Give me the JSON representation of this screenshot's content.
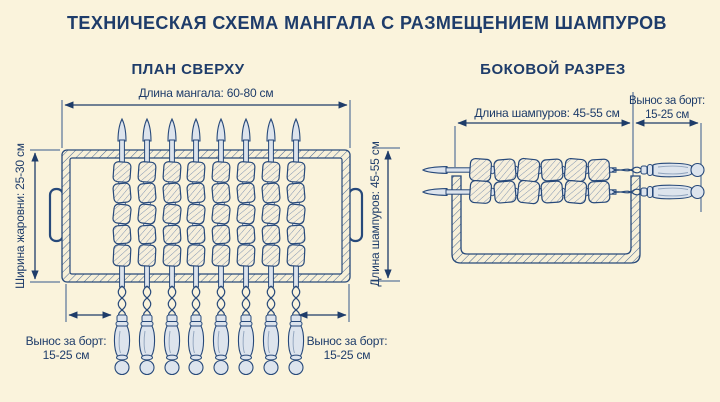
{
  "title": "ТЕХНИЧЕСКАЯ СХЕМА МАНГАЛА С РАЗМЕЩЕНИЕМ ШАМПУРОВ",
  "colors": {
    "background": "#faf3dc",
    "ink_navy": "#1e3c6a",
    "metal_fill": "#dde4ed",
    "meat_fill": "#f6efdc"
  },
  "top_view": {
    "label": "ПЛАН СВЕРХУ",
    "skewer_count": 8,
    "meat_pieces_per_skewer": 5,
    "dim_mangal_length": "Длина мангала: 60-80 см",
    "dim_brazier_width": "Ширина жаровни: 25-30 см",
    "dim_skewer_length": "Длина шампуров: 45-55 см",
    "dim_overhang_line1": "Вынос за борт:",
    "dim_overhang_line2": "15-25 см"
  },
  "side_view": {
    "label": "БОКОВОЙ РАЗРЕЗ",
    "skewer_count": 2,
    "meat_pieces_per_skewer": 6,
    "dim_skewer_length": "Длина шампуров: 45-55 см",
    "dim_overhang_line1": "Вынос за борт:",
    "dim_overhang_line2": "15-25 см"
  }
}
